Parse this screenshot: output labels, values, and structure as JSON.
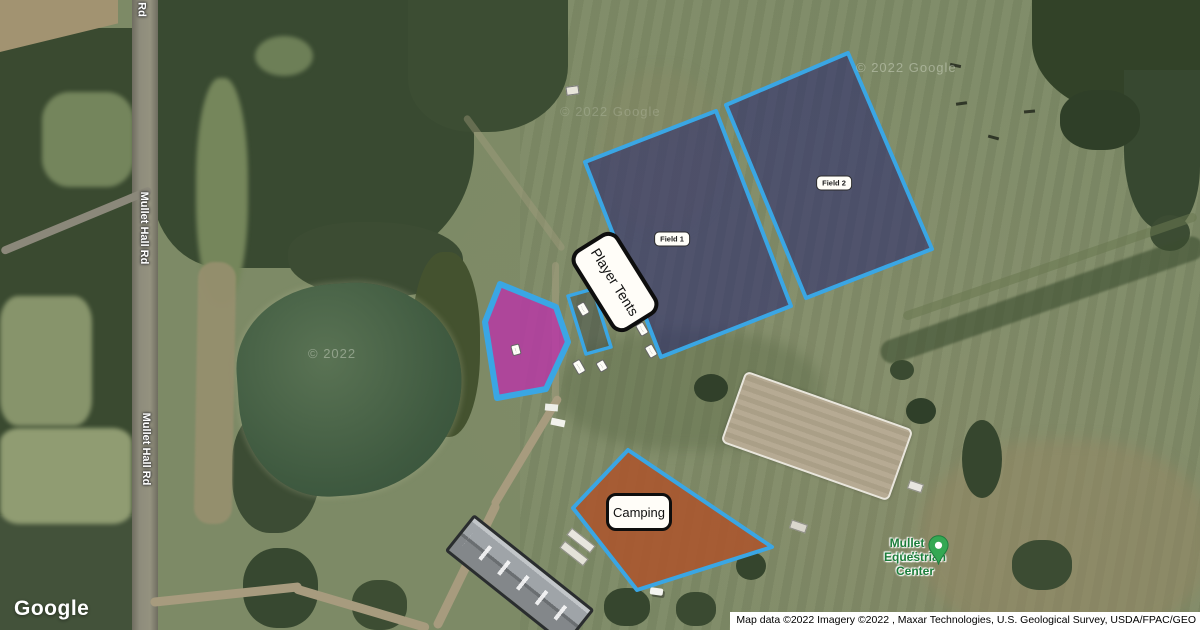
{
  "map_labels": {
    "road_top_fragment": "Rd",
    "road_upper": "Mullet Hall Rd",
    "road_lower": "Mullet Hall Rd",
    "watermark_pond": "© 2022",
    "watermark_field_east": "© 2022 Google",
    "watermark_field_north": "© 2022 Google"
  },
  "poi": {
    "name_line1": "Mullet Hall",
    "name_line2": "Equestrian Center",
    "text_color": "#1b7d3a",
    "marker_color": "#34a853"
  },
  "overlays": {
    "stroke_color": "#3aa6e4",
    "field1": {
      "label": "Field 1",
      "fill": "rgba(37,35,110,0.55)"
    },
    "field2": {
      "label": "Field 2",
      "fill": "rgba(37,35,110,0.55)"
    },
    "player_tents": {
      "label": "Player Tents"
    },
    "camping": {
      "label": "Camping",
      "fill": "rgba(173,84,42,0.85)"
    },
    "vendor_area": {
      "fill": "rgba(186,52,168,0.8)"
    },
    "schooling_area": {
      "fill": "rgba(25,35,50,0.3)"
    },
    "small_chips": [
      {
        "text": "·····"
      },
      {
        "text": "····"
      },
      {
        "text": "·····"
      },
      {
        "text": "·····"
      },
      {
        "text": "······"
      },
      {
        "text": "····"
      }
    ]
  },
  "footer": {
    "logo": "Google",
    "attribution": "Map data ©2022 Imagery ©2022 , Maxar Technologies, U.S. Geological Survey, USDA/FPAC/GEO"
  }
}
